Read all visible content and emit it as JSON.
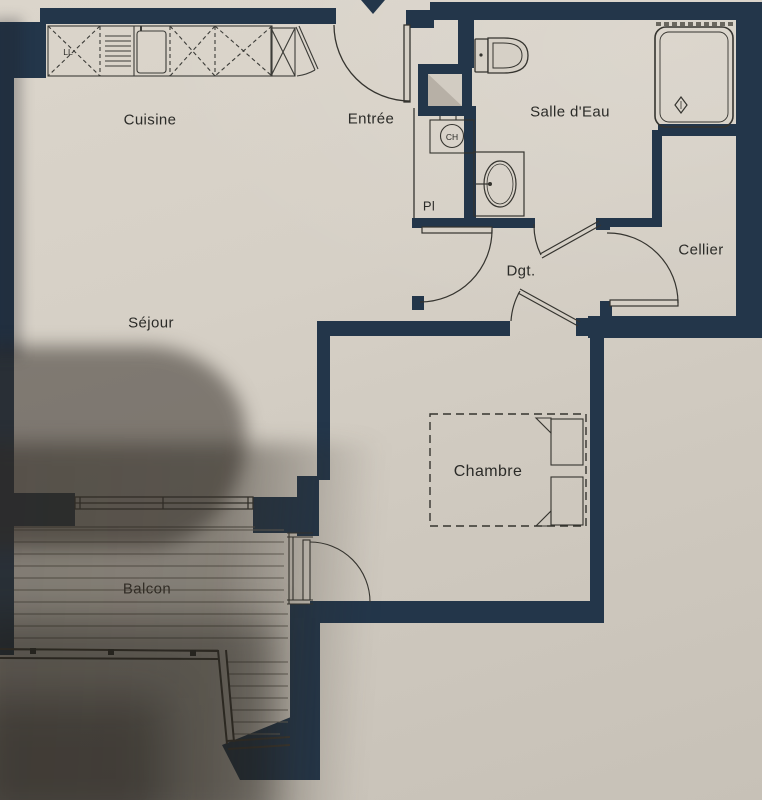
{
  "plan": {
    "type": "apartment-floor-plan",
    "rooms": {
      "cuisine": {
        "label": "Cuisine"
      },
      "entree": {
        "label": "Entrée"
      },
      "salle_deau": {
        "label": "Salle d'Eau"
      },
      "cellier": {
        "label": "Cellier"
      },
      "degagement": {
        "label": "Dgt."
      },
      "sejour": {
        "label": "Séjour"
      },
      "chambre": {
        "label": "Chambre"
      },
      "balcon": {
        "label": "Balcon"
      }
    },
    "annotations": {
      "placard": "Pl",
      "chauffe_eau": "CH",
      "lave_linge": "LL"
    },
    "colors": {
      "wall": "#23364a",
      "line": "#35342f",
      "paper": "#d6d0c6",
      "shaft_gray": "#b7b0a6"
    }
  }
}
